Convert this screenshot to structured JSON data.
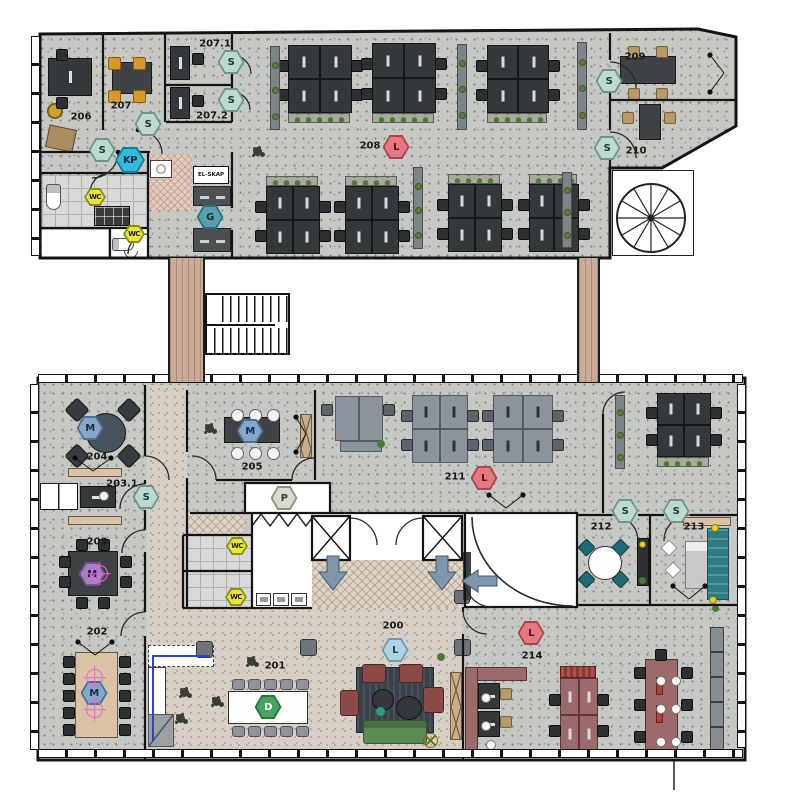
{
  "document": {
    "type": "architectural floor plan",
    "floors": 2
  },
  "texts": {
    "el_skap": "EL-SKAP"
  },
  "rooms": [
    {
      "id": "206",
      "label": "206",
      "x": 81,
      "y": 117
    },
    {
      "id": "207",
      "label": "207",
      "x": 121,
      "y": 106
    },
    {
      "id": "207-1",
      "label": "207.1",
      "x": 215,
      "y": 44
    },
    {
      "id": "207-2",
      "label": "207.2",
      "x": 212,
      "y": 116
    },
    {
      "id": "208",
      "label": "208",
      "x": 370,
      "y": 146
    },
    {
      "id": "209",
      "label": "209",
      "x": 635,
      "y": 57
    },
    {
      "id": "210",
      "label": "210",
      "x": 636,
      "y": 151
    },
    {
      "id": "204",
      "label": "204",
      "x": 97,
      "y": 457
    },
    {
      "id": "203-1",
      "label": "203.1",
      "x": 122,
      "y": 484
    },
    {
      "id": "203",
      "label": "203",
      "x": 97,
      "y": 542
    },
    {
      "id": "202",
      "label": "202",
      "x": 97,
      "y": 632
    },
    {
      "id": "205",
      "label": "205",
      "x": 252,
      "y": 467
    },
    {
      "id": "211",
      "label": "211",
      "x": 455,
      "y": 477
    },
    {
      "id": "212",
      "label": "212",
      "x": 601,
      "y": 527
    },
    {
      "id": "213",
      "label": "213",
      "x": 694,
      "y": 527
    },
    {
      "id": "214",
      "label": "214",
      "x": 532,
      "y": 656
    },
    {
      "id": "200",
      "label": "200",
      "x": 393,
      "y": 626
    },
    {
      "id": "201",
      "label": "201",
      "x": 275,
      "y": 666
    }
  ],
  "markers": [
    {
      "letter": "S",
      "type": "s",
      "x": 231,
      "y": 62
    },
    {
      "letter": "S",
      "type": "s",
      "x": 231,
      "y": 100
    },
    {
      "letter": "S",
      "type": "s",
      "x": 148,
      "y": 124
    },
    {
      "letter": "S",
      "type": "s",
      "x": 102,
      "y": 150
    },
    {
      "letter": "S",
      "type": "s",
      "x": 609,
      "y": 81
    },
    {
      "letter": "S",
      "type": "s",
      "x": 607,
      "y": 148
    },
    {
      "letter": "KP",
      "type": "kp",
      "x": 130,
      "y": 160
    },
    {
      "letter": "G",
      "type": "g",
      "x": 210,
      "y": 217
    },
    {
      "letter": "WC",
      "type": "wc",
      "x": 95,
      "y": 197
    },
    {
      "letter": "WC",
      "type": "wc",
      "x": 134,
      "y": 234
    },
    {
      "letter": "L",
      "type": "l_red",
      "x": 396,
      "y": 147
    },
    {
      "letter": "M",
      "type": "m_blue",
      "x": 90,
      "y": 428
    },
    {
      "letter": "S",
      "type": "s",
      "x": 146,
      "y": 497
    },
    {
      "letter": "M",
      "type": "m_purple",
      "x": 92,
      "y": 574
    },
    {
      "letter": "M",
      "type": "m_blue",
      "x": 94,
      "y": 693
    },
    {
      "letter": "M",
      "type": "m_blue",
      "x": 250,
      "y": 431
    },
    {
      "letter": "P",
      "type": "p",
      "x": 284,
      "y": 498
    },
    {
      "letter": "L",
      "type": "l_red",
      "x": 484,
      "y": 478
    },
    {
      "letter": "S",
      "type": "s",
      "x": 625,
      "y": 511
    },
    {
      "letter": "S",
      "type": "s",
      "x": 676,
      "y": 511
    },
    {
      "letter": "WC",
      "type": "wc",
      "x": 237,
      "y": 546
    },
    {
      "letter": "WC",
      "type": "wc",
      "x": 236,
      "y": 597
    },
    {
      "letter": "L",
      "type": "l_blue",
      "x": 395,
      "y": 650
    },
    {
      "letter": "D",
      "type": "d",
      "x": 268,
      "y": 707
    },
    {
      "letter": "L",
      "type": "l_red",
      "x": 531,
      "y": 633
    }
  ],
  "marker_colors": {
    "s": "#bcd8cf",
    "kp": "#35bada",
    "g": "#58a0ae",
    "wc": "#e9e53d",
    "l_red": "#e47780",
    "l_blue": "#aed2e4",
    "m_blue": "#85a8ca",
    "m_purple": "#a87fc6",
    "p": "#dbd8cd",
    "d": "#49a45e"
  },
  "floor_colors": {
    "office_floor": "#c7c8c4",
    "lobby_floor": "#d6cfc6",
    "corridor_link": "#c9ac97",
    "desk_dark": "#35383a",
    "desk_gray": "#8b949c",
    "desk_maroon": "#9c6a6a"
  }
}
